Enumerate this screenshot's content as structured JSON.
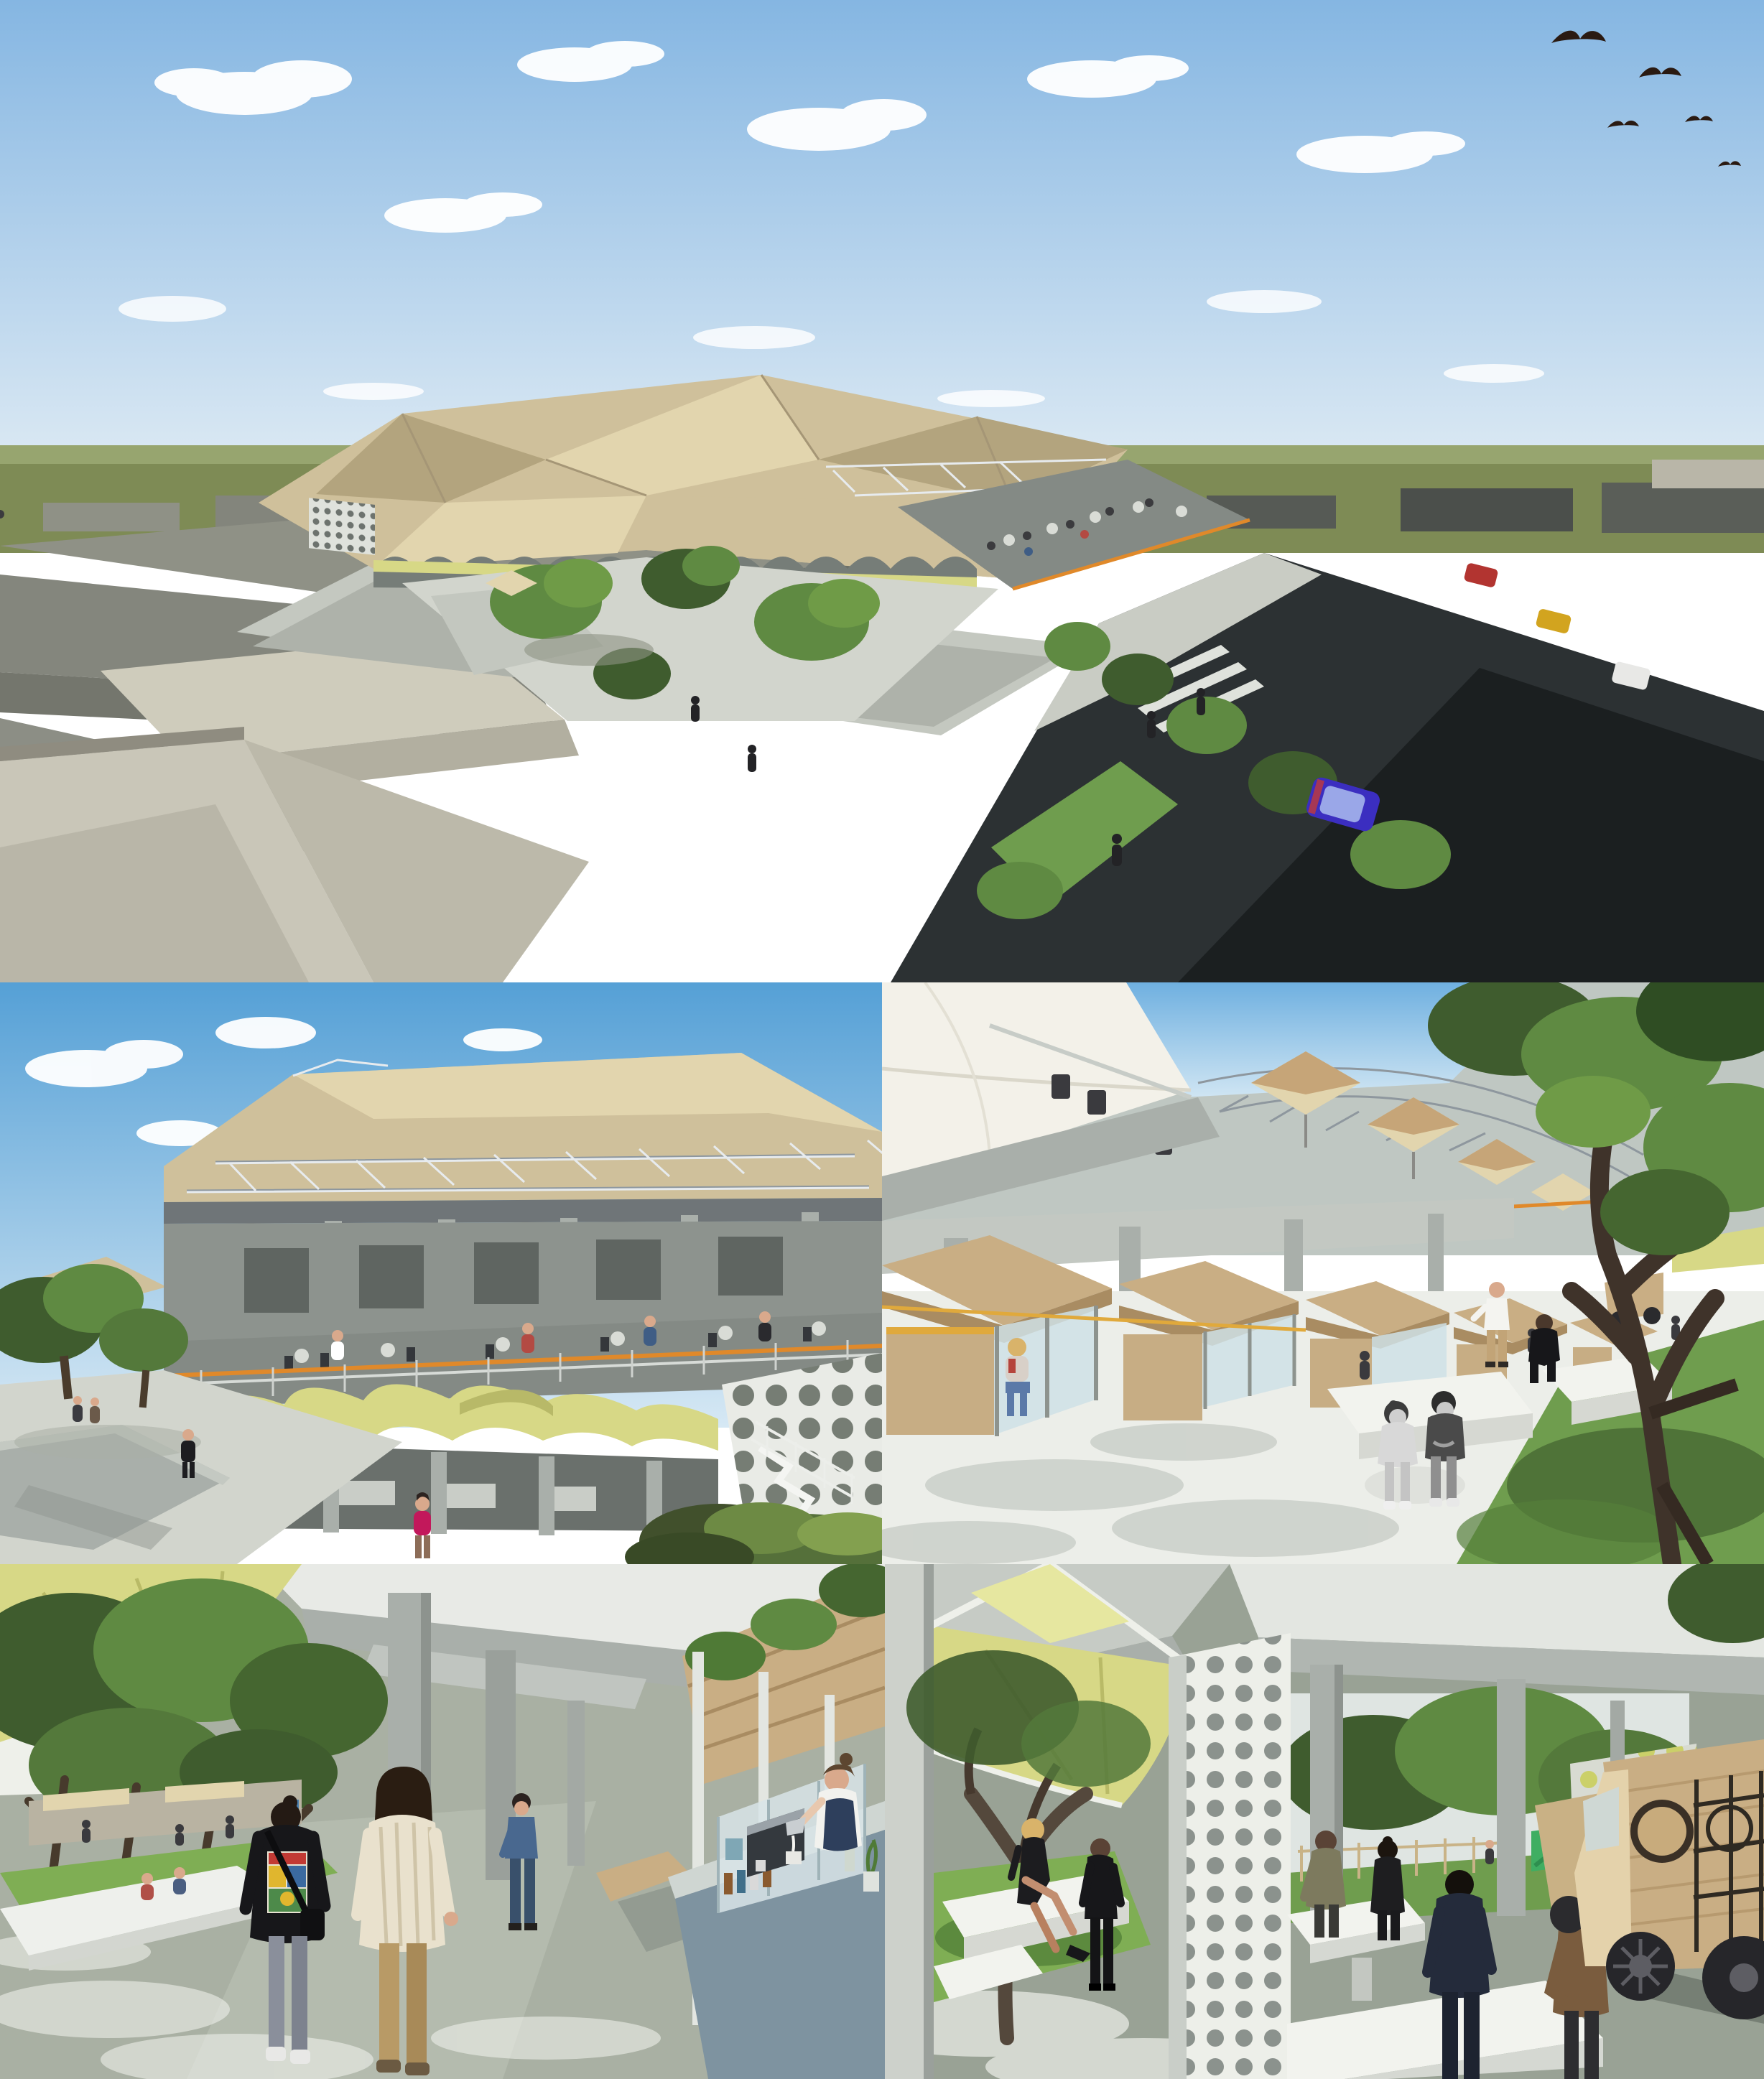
{
  "collage": {
    "title": "Architectural rendering collage of a public market and plaza redevelopment, five untitled panels with no text",
    "panel_count": 5,
    "grid": "one full-width aerial render on top, two street-level renders in the middle row, two under-canopy renders in the bottom row"
  },
  "palette": {
    "sky-top": "#6fa9da",
    "sky-horizon": "#dcebf5",
    "ground-olive": "#7e8b55",
    "building-dark": "#3b3f3d",
    "building-grey": "#8f9186",
    "building-light": "#cfccbc",
    "roof-tan": "#cfc09b",
    "roof-tan-shade": "#b3a47e",
    "roof-tan-light": "#e2d5ae",
    "canopy-lime": "#d7d886",
    "canopy-lime-shade": "#b8b968",
    "rail-orange": "#e0892a",
    "concrete": "#a9afaa",
    "concrete-light": "#cdd1cb",
    "concrete-dark": "#848a85",
    "pavement": "#d2d5cd",
    "asphalt": "#2c3133",
    "grass": "#7fae54",
    "grass-deep": "#6f9d4e",
    "tree-green": "#5f8a42",
    "tree-dark": "#3f5c2e",
    "wood": "#c9ae84",
    "wood-shade": "#a98c62",
    "kiosk-blue": "#7e93a0",
    "floor-sage": "#a9b0a3",
    "car-blue": "#3b2ec0",
    "skin": "#d9a98c"
  },
  "panels": {
    "aerial": {
      "label": "aerial-overview",
      "description": "Aerial view of a market complex with faceted tan tent roofs and lime-green awnings set inside a grey low-rise city; tree-planted courtyard plaza behind a perimeter wall, open-air roof terrace with diners, dark asphalt road with a blue hatchback and red, yellow and white vehicles, pedestrians, and five birds in a blue sky with scattered clouds.",
      "features": [
        "blue sky with cumulus clouds",
        "five bird silhouettes top right",
        "olive-green horizon plain",
        "grey warehouse blocks left",
        "dark city blocks right",
        "faceted tan market tent roofs",
        "lime awning band with scalloped arches",
        "courtyard trees and plaza",
        "roof terrace with tables",
        "perimeter concrete wall",
        "asphalt road with blue hatchback",
        "zebra crossing and pedestrians"
      ]
    },
    "plaza": {
      "label": "plaza-eye-level",
      "description": "Street-level view of the two-storey market: white steel trusses carrying a tan fabric roof over an upper dining terrace with an orange railing band, a scalloped lime-green canopy over ground-floor stalls, a perforated concrete screen wall with a white stair at right, and a paved plaza with trees and walking figures at left, one woman in a magenta top in the foreground.",
      "features": [
        "blue sky and clouds",
        "tan truss roof canopy",
        "upper terrace with tables and diners",
        "orange railing band",
        "scalloped lime canopy",
        "perforated dot screen wall",
        "white external stair over shrubs",
        "paved plaza with grey platform",
        "trees and pedestrians",
        "woman in magenta top"
      ]
    },
    "stalls": {
      "label": "stall-courtyard",
      "description": "Courtyard between levels: a receding row of timber market kiosks with pitched wooden roofs, an upper balcony with tan umbrellas and a white shade sail, a large spreading tree at right over grass, white concrete benches, two children in greyscale sitting together on a round stool, a man in black seated and a man in a white shirt standing.",
      "features": [
        "white shade sail upper left",
        "tan terrace umbrellas",
        "orange cable railing",
        "timber kiosk row",
        "concrete columns and slab",
        "two greyscale children on stool",
        "seated man in black",
        "standing man in white shirt",
        "seated woman at first stall",
        "large tree with gnarled trunk",
        "grass patch and white benches",
        "distant timber food cart"
      ]
    },
    "walkway": {
      "label": "market-walkway",
      "description": "Covered walkway beneath concrete beams and a lime-yellow canopy: two women walk away from the camera (one in a black jacket with a comic-book print, one in a cream striped shirt), a man in a blue shirt stands mid-distance, and at right a barista in a white tee and navy apron pours milk at a blue-grey coffee kiosk topped by wooden planter boxes; trees, grass and market stalls line the left edge.",
      "features": [
        "lime canopy and concrete beams",
        "grove of trees over grass",
        "distant stall canopies with visitors",
        "low white seating wall",
        "woman in black jacket with comic print",
        "woman in cream striped shirt",
        "man in blue shirt",
        "coffee kiosk with glass display",
        "barista pouring milk",
        "wooden planter band with shrubs",
        "sage screed floor with dappled light"
      ]
    },
    "foodhall": {
      "label": "food-hall",
      "description": "Under-croft food hall: grey concrete columns and beams with a lime-yellow tensile canopy, a white perforated screen wall, a gnarled courtyard tree over bright grass where a blonde woman in black sits near a standing man in a dark suit, groups of people standing at white concrete high tables, and a plywood food truck with dark wheels; a playground and fenced courtyard show in the background.",
      "features": [
        "concrete beam ceiling",
        "lime canopy with white gable",
        "perforated screen wall",
        "courtyard tree and grass",
        "seated blonde woman in black dress",
        "standing man in dark suit",
        "white high tables with standing groups",
        "plywood food truck with circular cut-outs",
        "second timber cart",
        "background playground, fence and trees",
        "lime-lit perforated back panel"
      ]
    }
  }
}
